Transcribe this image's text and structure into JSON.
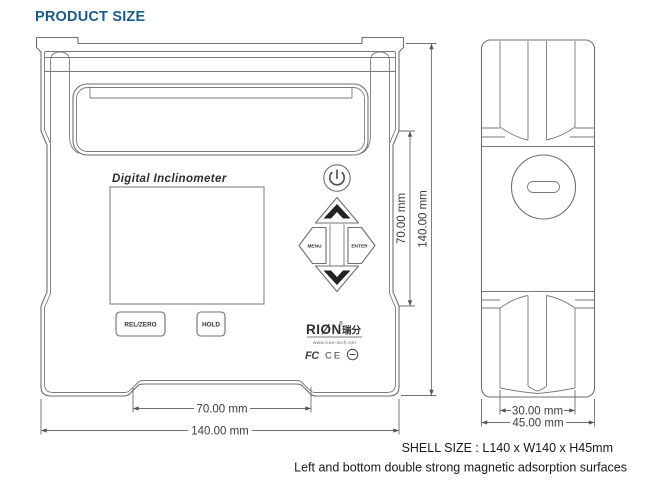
{
  "title": "PRODUCT SIZE",
  "colors": {
    "title_blue": "#1c5b87",
    "drawing_line": "#6f6f6f",
    "dim_text": "#3c3c3c",
    "note_text": "#1a1a1a",
    "background": "#ffffff"
  },
  "front_view": {
    "brand": "Digital Inclinometer",
    "keys": {
      "rel_zero": "REL/ZERO",
      "hold": "HOLD",
      "menu": "MENU",
      "enter": "ENTER"
    },
    "icons": [
      "power-icon",
      "arrow-up-icon",
      "arrow-down-icon",
      "emc-circle-mark"
    ],
    "logo": {
      "brand": "RIØN",
      "brand_cn": "瑞分",
      "reg_mark": "®",
      "website": "www.rion-tech.net",
      "cert_fcc": "FC",
      "cert_ce": "CE"
    }
  },
  "dimensions": {
    "front_width_half": "70.00 mm",
    "front_width_total": "140.00 mm",
    "front_height_half": "70.00 mm",
    "front_height_total": "140.00 mm",
    "side_width_inner": "30.00 mm",
    "side_width_total": "45.00 mm"
  },
  "notes": {
    "shell_size": "SHELL SIZE : L140 x W140 x H45mm",
    "magnetic": "Left and bottom double strong magnetic adsorption surfaces"
  }
}
